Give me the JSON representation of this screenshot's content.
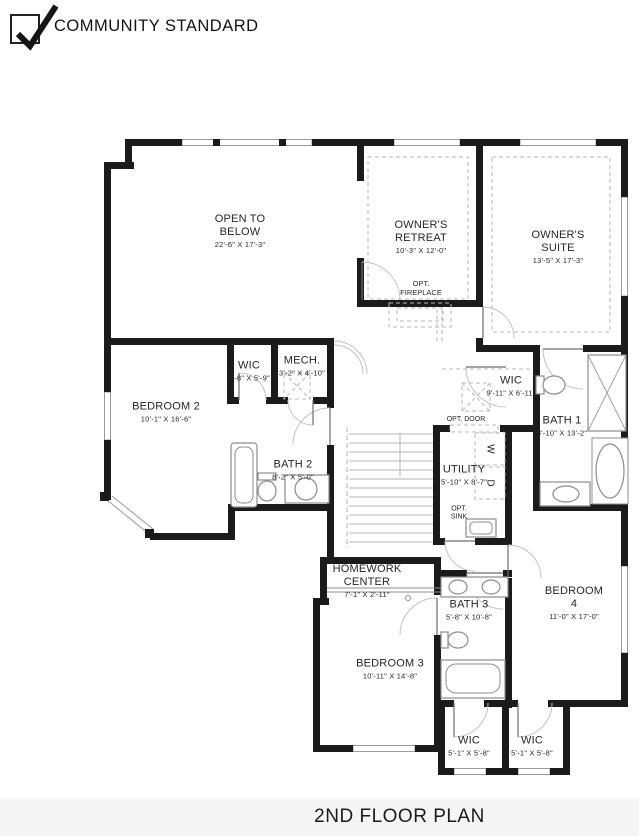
{
  "header": {
    "label": "COMMUNITY STANDARD",
    "checked": true
  },
  "footer": {
    "title": "2ND FLOOR PLAN"
  },
  "rooms": [
    {
      "id": "open-to-below",
      "name": "OPEN TO\nBELOW",
      "dims": "22'-6\" X 17'-3\""
    },
    {
      "id": "owners-retreat",
      "name": "OWNER'S\nRETREAT",
      "dims": "10'-3\" X 12'-0\""
    },
    {
      "id": "owners-suite",
      "name": "OWNER'S SUITE",
      "dims": "13'-5\" X 17'-3\""
    },
    {
      "id": "wic-bedroom2",
      "name": "WIC",
      "dims": "4'-8\" X 5'-9\""
    },
    {
      "id": "mech",
      "name": "MECH.",
      "dims": "3'-2\" X 4'-10\""
    },
    {
      "id": "bedroom2",
      "name": "BEDROOM 2",
      "dims": "10'-1\" X 16'-6\""
    },
    {
      "id": "bath2",
      "name": "BATH 2",
      "dims": "8'-2\" X 5'-0\""
    },
    {
      "id": "wic-owners",
      "name": "WIC",
      "dims": "9'-11\" X 6'-11\""
    },
    {
      "id": "bath1",
      "name": "BATH 1",
      "dims": "8'-10\" X 13'-2\""
    },
    {
      "id": "utility",
      "name": "UTILITY",
      "dims": "5'-10\" X 8'-7\""
    },
    {
      "id": "homework-center",
      "name": "HOMEWORK\nCENTER",
      "dims": "7'-1\" X 2'-11\""
    },
    {
      "id": "bath3",
      "name": "BATH 3",
      "dims": "5'-8\" X 10'-8\""
    },
    {
      "id": "bedroom4",
      "name": "BEDROOM 4",
      "dims": "11'-0\" X 17'-0\""
    },
    {
      "id": "bedroom3",
      "name": "BEDROOM 3",
      "dims": "10'-11\" X 14'-8\""
    },
    {
      "id": "wic-bedroom3",
      "name": "WIC",
      "dims": "5'-1\" X 5'-8\""
    },
    {
      "id": "wic-bedroom4",
      "name": "WIC",
      "dims": "5'-1\" X 5'-8\""
    }
  ],
  "annotations": {
    "opt_fireplace": "OPT.\nFIREPLACE",
    "opt_door": "OPT. DOOR",
    "washer": "W",
    "dryer": "D",
    "opt_sink": "OPT.\nSINK"
  },
  "colors": {
    "wall": "#1b1b1b",
    "window": "#9a9a9a",
    "fixture": "#8c8c8c",
    "dashed": "#b8b8b8",
    "text": "#262626"
  }
}
